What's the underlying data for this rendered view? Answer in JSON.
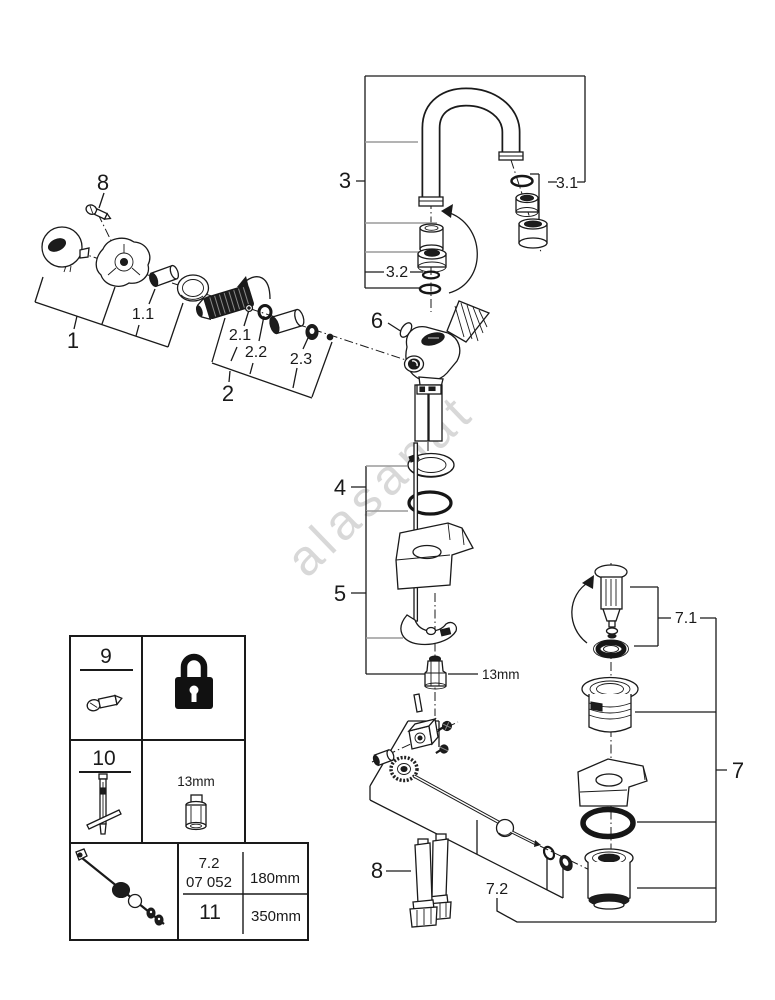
{
  "watermark": "alasanat",
  "colors": {
    "line": "#1a1a1a",
    "gray_leader": "#9a9a9a",
    "watermark": "#d8d8d8",
    "background": "#ffffff",
    "padlock": "#111111"
  },
  "callouts": {
    "n1": "1",
    "n1_1": "1.1",
    "n2": "2",
    "n2_1": "2.1",
    "n2_2": "2.2",
    "n2_3": "2.3",
    "n3": "3",
    "n3_1": "3.1",
    "n3_2": "3.2",
    "n4": "4",
    "n5": "5",
    "n6": "6",
    "n7": "7",
    "n7_1": "7.1",
    "n7_2": "7.2",
    "n8_handle_screw": "8",
    "n8_hoses": "8",
    "nut_wrench_size": "13mm"
  },
  "legend_table": {
    "rows": [
      {
        "item_no": "9",
        "part_icon": "grub-screw-icon",
        "tool_icon": "padlock-icon"
      },
      {
        "item_no": "10",
        "part_icon": "mounting-tool-icon",
        "tool_size_label": "13mm",
        "tool_icon": "socket-icon"
      },
      {
        "item_no": "11",
        "part_icon": "pop-up-rod-icon",
        "ref_label": "7.2",
        "order_code": "07 052",
        "length_short": "180mm",
        "length_long": "350mm"
      }
    ]
  }
}
